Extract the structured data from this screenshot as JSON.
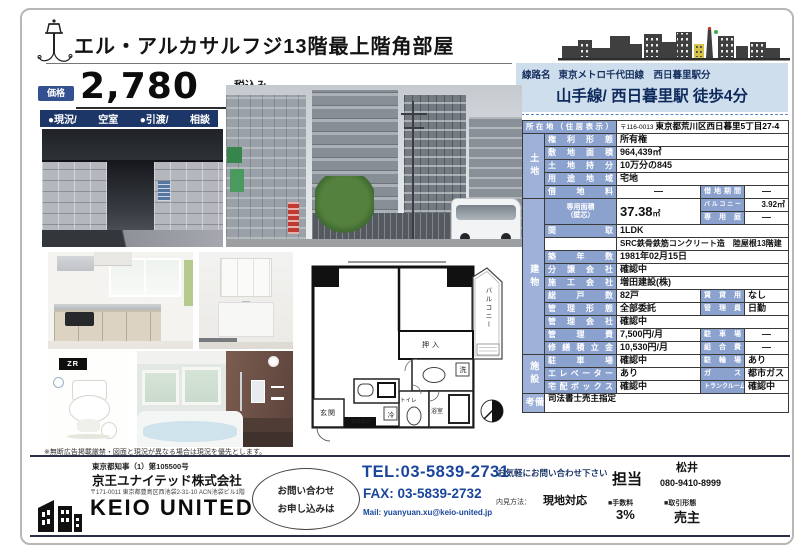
{
  "header": {
    "title": "エル・アルカサルフジ13階最上階角部屋"
  },
  "price": {
    "badge": "価格",
    "amount": "2,780",
    "tax_note": "税込み",
    "unit": "万円"
  },
  "status": {
    "items": [
      "●現況/",
      "空室",
      "●引渡/",
      "相談"
    ]
  },
  "access": {
    "label": "線路名",
    "line": "東京メトロ千代田線　西日暮里駅分",
    "walk": "山手線/ 西日暮里駅 徒歩4分"
  },
  "photos": {
    "toilet_tag": "ZR"
  },
  "floorplan": {
    "balcony": "バルコニー",
    "closet": "押入",
    "washbasin": "洗",
    "toilet": "トイレ",
    "bath": "浴室",
    "entrance": "玄関",
    "entrance_storage": "玄関収納",
    "fridge": "冷"
  },
  "disclaimer": "※無断広告掲載厳禁・図面と現況が異なる場合は現況を優先とします。",
  "table": {
    "address": {
      "label": "所在地（住居表示）",
      "zip": "〒116-0013",
      "value": "東京都荒川区西日暮里5丁目27-4"
    },
    "groups": {
      "land": "土地",
      "building": "建物",
      "facility": "施設",
      "notes": "備考"
    },
    "land": [
      {
        "l": "権利形態",
        "v": "所有権"
      },
      {
        "l": "敷地面積",
        "v": "964,439㎡"
      },
      {
        "l": "土地持分",
        "v": "10万分の845"
      },
      {
        "l": "用途地域",
        "v": "宅地"
      },
      {
        "l": "借地料",
        "v": "―",
        "l2": "借地期間",
        "v2": "―"
      }
    ],
    "area": {
      "l": "専用面積",
      "l_sub": "（壁芯）",
      "v": "37.38",
      "unit": "㎡",
      "r1l": "バルコニー",
      "r1v": "3.92㎡",
      "r2l": "専用庭",
      "r2v": "―"
    },
    "building": [
      {
        "l": "間取",
        "v": "1LDK"
      },
      {
        "l": "",
        "v": "SRC鉄骨鉄筋コンクリート造　陸屋根13階建"
      },
      {
        "l": "築年数",
        "v": "1981年02月15日"
      },
      {
        "l": "分譲会社",
        "v": "確認中"
      },
      {
        "l": "施工会社",
        "v": "増田建設(株)"
      },
      {
        "l": "総戸数",
        "v": "82戸",
        "l2": "賃貸用",
        "v2": "なし"
      },
      {
        "l": "管理形態",
        "v": "全部委託",
        "l2": "管理員",
        "v2": "日勤"
      },
      {
        "l": "管理会社",
        "v": "確認中"
      },
      {
        "l": "管理費",
        "v": "7,500円/月",
        "l2": "駐車場",
        "v2": "―"
      },
      {
        "l": "修繕積立金",
        "v": "10,530円/月",
        "l2": "組合費",
        "v2": "―"
      }
    ],
    "facility": [
      {
        "l": "駐車場",
        "v": "確認中",
        "l2": "駐輪場",
        "v2": "あり"
      },
      {
        "l": "エレベーター",
        "v": "あり",
        "l2": "ガス",
        "v2": "都市ガス"
      },
      {
        "l": "宅配ボックス",
        "v": "確認中",
        "l2": "トランクルーム",
        "v2": "確認中"
      }
    ],
    "notes": "司法書士売主指定"
  },
  "footer": {
    "license": "東京都知事（1）第105500号",
    "company": "京王ユナイテッド株式会社",
    "company_address": "〒171-0011 東京都豊島区西池袋2-31-10 ACN池袋ビル1階",
    "logo_text": "KEIO UNITED",
    "cta_line1": "お問い合わせ",
    "cta_line2": "お申し込みは",
    "tel": "TEL:03-5839-2731",
    "fax": "FAX: 03-5839-2732",
    "mail": "Mail: yuanyuan.xu@keio-united.jp",
    "notice": "お気軽にお問い合わせ下さい",
    "viewing_label": "内見方法：",
    "viewing_value": "現地対応",
    "contact_label": "担当",
    "contact_name": "松井",
    "contact_phone": "080-9410-8999",
    "fee_label": "■手数料",
    "fee_value": "3%",
    "deal_label": "■取引形態",
    "deal_value": "売主"
  }
}
